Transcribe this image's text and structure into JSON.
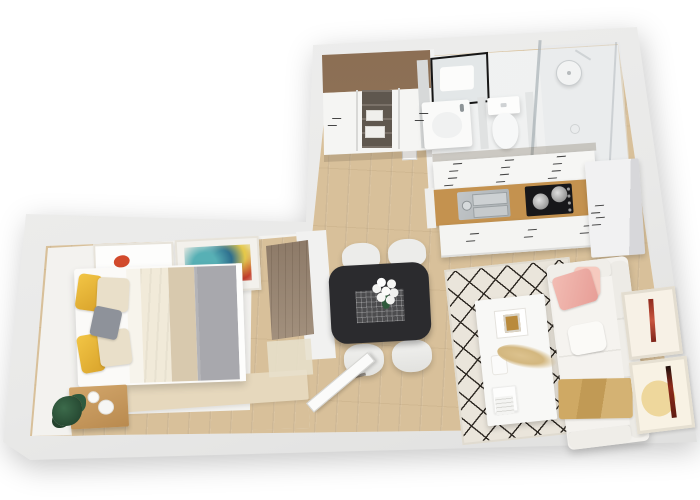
{
  "scene": {
    "type": "3d-floor-plan-render",
    "description": "Top-down 3D rendering of a one-bedroom apartment floor plan",
    "background": "#ffffff"
  },
  "palette": {
    "wall": "#e9e9e8",
    "wallEdge": "#c9c9c7",
    "floorWhite": "#f7f6f4",
    "wood": "#d8c09a",
    "bathFloor": "#eef0f0",
    "bedroomFloor": "#f3f2ef",
    "runnerBeige": "#e6d8bd",
    "closetWood": "#9a7c5f",
    "wardrobeWood": "#98866f",
    "nightstand": "#c69d63",
    "counter": "#c4924f",
    "steel": "#b9bec1",
    "cooktop": "#17171a",
    "table": "#2b2b2e",
    "chair": "#ececea",
    "rug": "#eae5db",
    "rugLine": "#2e2923",
    "sofa": "#f3f1ed",
    "pink": "#efb6ad",
    "gold": "#c8a15c",
    "yellow": "#eec03f",
    "cream": "#e9dfc9",
    "pillowGray": "#8e929a",
    "duvet": "#f1ead9",
    "blanketBeige": "#d8c9ae",
    "blanketGray": "#a8a8ad",
    "plantGreen": "#2f5a3c",
    "artRed": "#a93423",
    "artYellow": "#ecd28f",
    "mirrorFrame": "#161616"
  },
  "rooms": {
    "bedroom": {
      "label": "Bedroom",
      "furniture": [
        "double bed with yellow, cream and gray pillows",
        "cream, beige and gray bedding",
        "wooden nightstand with plant and cups",
        "wooden wardrobe",
        "two abstract art frames"
      ]
    },
    "hallway": {
      "label": "Hallway",
      "furniture": [
        "built-in closet with wood top and white sliding doors"
      ]
    },
    "bathroom": {
      "label": "Bathroom",
      "furniture": [
        "vanity with black-framed mirror",
        "toilet",
        "walk-in shower with glass panel and rain shower head"
      ]
    },
    "kitchen": {
      "label": "Kitchen",
      "furniture": [
        "white wall cabinets",
        "wood countertop with steel sink",
        "black cooktop with two pots",
        "white base cabinets",
        "tall cabinet"
      ]
    },
    "dining": {
      "label": "Dining area",
      "furniture": [
        "black dining table with gray runner",
        "white flower bouquet",
        "four white chairs"
      ]
    },
    "living": {
      "label": "Living room",
      "furniture": [
        "white sofa with pink pillow and gold throw",
        "white coffee table with pampas decor",
        "diamond lattice rug",
        "two framed artworks"
      ]
    },
    "entry": {
      "label": "Entry",
      "furniture": [
        "open entry door"
      ]
    }
  }
}
